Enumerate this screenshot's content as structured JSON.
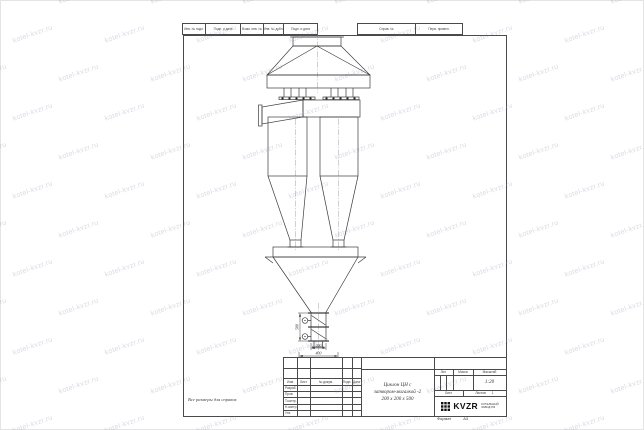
{
  "watermark": {
    "text": "kotel-kvzr.ru"
  },
  "header_strip": {
    "cells": [
      "Инв. № подл.",
      "Подп. и дата",
      "Взам. инв. №",
      "Инв. № дубл.",
      "Подп. и дата"
    ],
    "wide_cells": [
      "Справ. №",
      "Перв. примен."
    ]
  },
  "drawing": {
    "dimensions": {
      "valve_height": "500",
      "valve_width": "200",
      "flange_width": "400"
    }
  },
  "note": "Все размеры для справок",
  "title_block": {
    "revision_columns": [
      "Изм.",
      "Лист",
      "№ докум.",
      "Подп.",
      "Дата"
    ],
    "signature_rows": [
      "Разраб.",
      "Пров.",
      "Т.контр.",
      "Н.контр.",
      "Утв."
    ],
    "title_lines": [
      "Циклон ЦН с",
      "затвором-мигалкой -2",
      "200 х 200 х 500"
    ],
    "lit_label": "Лит.",
    "mass_label": "Масса",
    "scale_label": "Масштаб",
    "scale_value": "1:20",
    "sheet_label": "Лист",
    "sheets_label": "Листов",
    "sheets_value": "1",
    "logo_text": "KVZR",
    "company_lines": [
      "КОТЕЛЬНЫЙ",
      "ЗАВОД РФ"
    ],
    "format_label": "Формат",
    "format_value": "А3"
  }
}
